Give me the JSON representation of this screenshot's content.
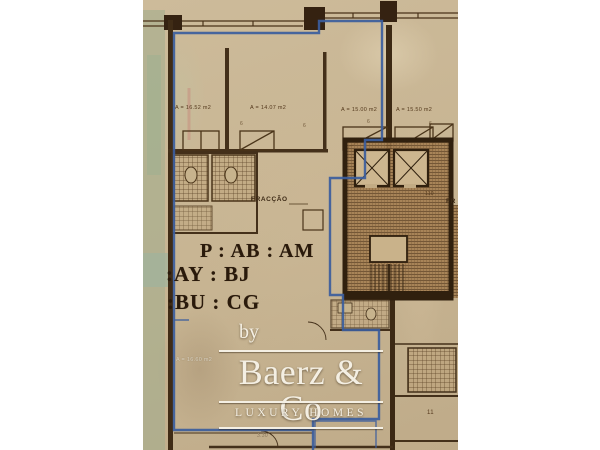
{
  "floorplan": {
    "area_labels": {
      "room1": "A = 16.52 m2",
      "room2": "A = 14.07 m2",
      "room3": "A = 15.00 m2",
      "room4": "A = 15.50 m2",
      "living": "A = 16.60 m2"
    },
    "fraccao": "FRACÇÃO",
    "fraccao_right": "FR",
    "stamp": {
      "line1": "P : AB : AM",
      "line2": ":AY : BJ",
      "line3": ":BU : CG"
    },
    "numbers": {
      "room11": "11",
      "core": "110",
      "dim": "3.30",
      "marker1": "6",
      "marker2": "6",
      "marker3": "6",
      "marker4": "6"
    }
  },
  "watermark": {
    "by": "by",
    "brand": "Baerz & Co",
    "tagline": "LUXURY HOMES"
  },
  "colors": {
    "paper": "#c9b695",
    "ink": "#402c16",
    "outline_blue": "#3b5d9d",
    "green_wash": "#a3ad8e",
    "watermark_white": "#f4efe3"
  }
}
